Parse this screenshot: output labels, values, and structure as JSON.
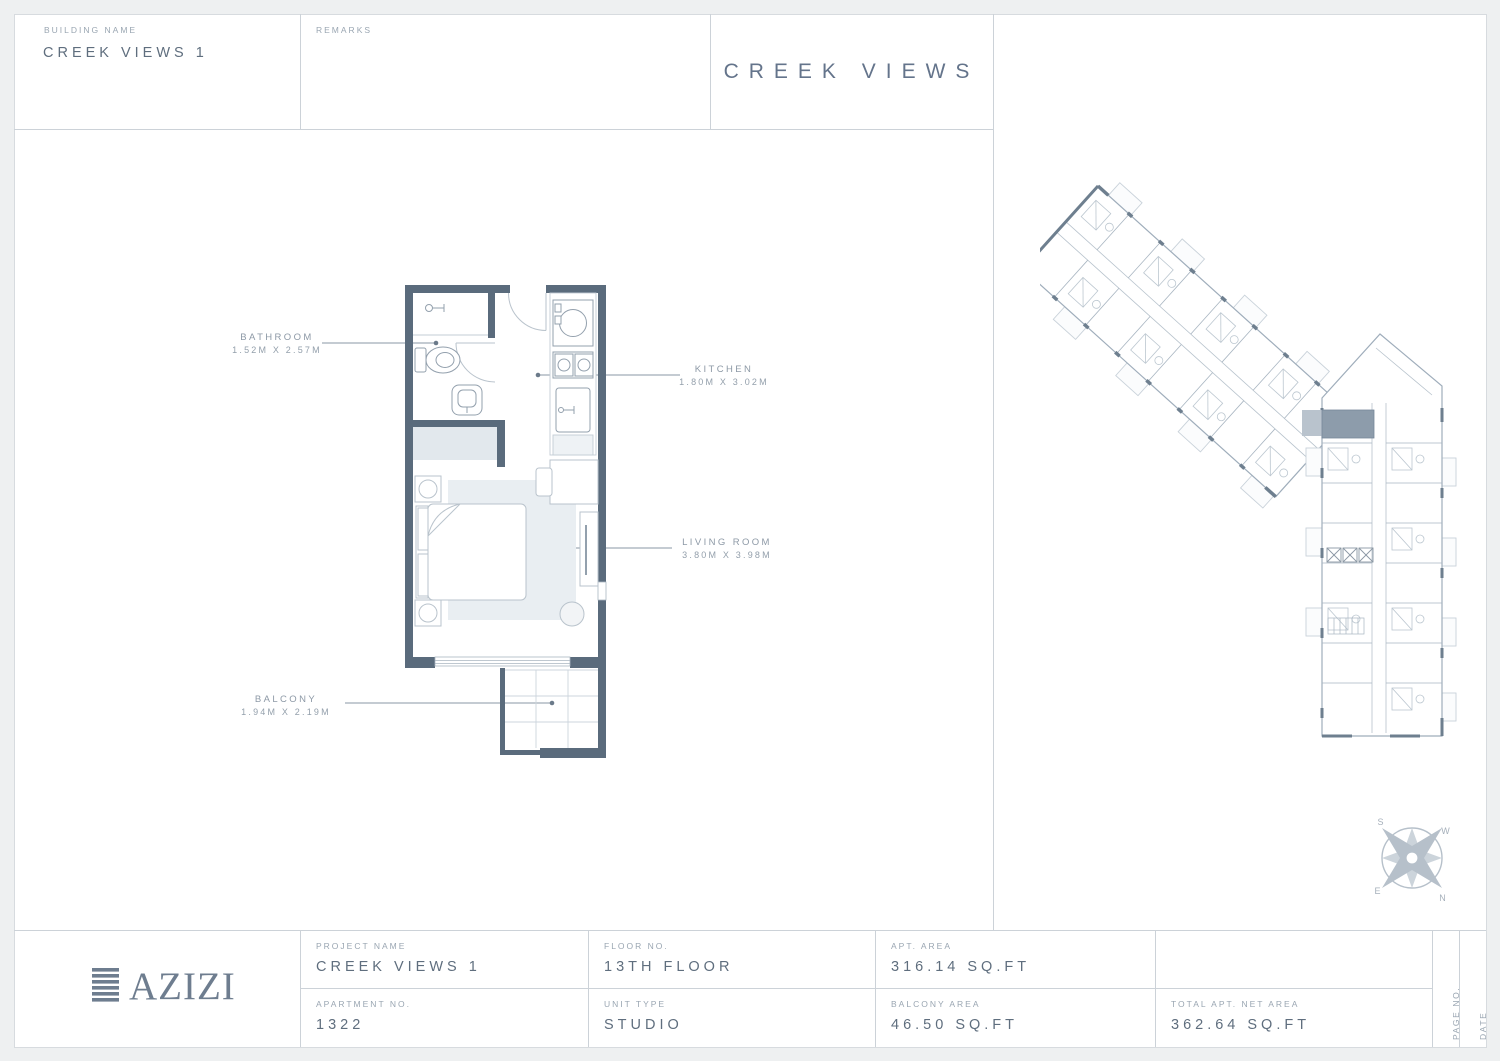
{
  "header": {
    "building_name_label": "BUILDING NAME",
    "building_name": "CREEK VIEWS 1",
    "remarks_label": "REMARKS",
    "sheet_title": "CREEK VIEWS"
  },
  "floorplan": {
    "rooms": [
      {
        "name": "BATHROOM",
        "dims": "1.52M X 2.57M"
      },
      {
        "name": "KITCHEN",
        "dims": "1.80M X 3.02M"
      },
      {
        "name": "LIVING ROOM",
        "dims": "3.80M X 3.98M"
      },
      {
        "name": "BALCONY",
        "dims": "1.94M X 2.19M"
      }
    ]
  },
  "compass": {
    "north": "N",
    "south": "S",
    "east": "E",
    "west": "W"
  },
  "footer": {
    "logo": "AZIZI",
    "project_name_label": "PROJECT NAME",
    "project_name": "CREEK VIEWS 1",
    "floor_no_label": "FLOOR NO.",
    "floor_no": "13TH FLOOR",
    "apt_area_label": "APT. AREA",
    "apt_area": "316.14 SQ.FT",
    "apartment_no_label": "APARTMENT NO.",
    "apartment_no": "1322",
    "unit_type_label": "UNIT TYPE",
    "unit_type": "STUDIO",
    "balcony_area_label": "BALCONY AREA",
    "balcony_area": "46.50 SQ.FT",
    "total_area_label": "TOTAL APT. NET AREA",
    "total_area": "362.64 SQ.FT",
    "page_no_label": "PAGE NO.",
    "date_label": "DATE"
  },
  "colors": {
    "wall": "#5a6b7c",
    "value_text": "#5f6e7e",
    "label_text": "#9aa6b2",
    "grid_line": "#ccd2d8",
    "highlight_unit": "#8d9cab"
  }
}
